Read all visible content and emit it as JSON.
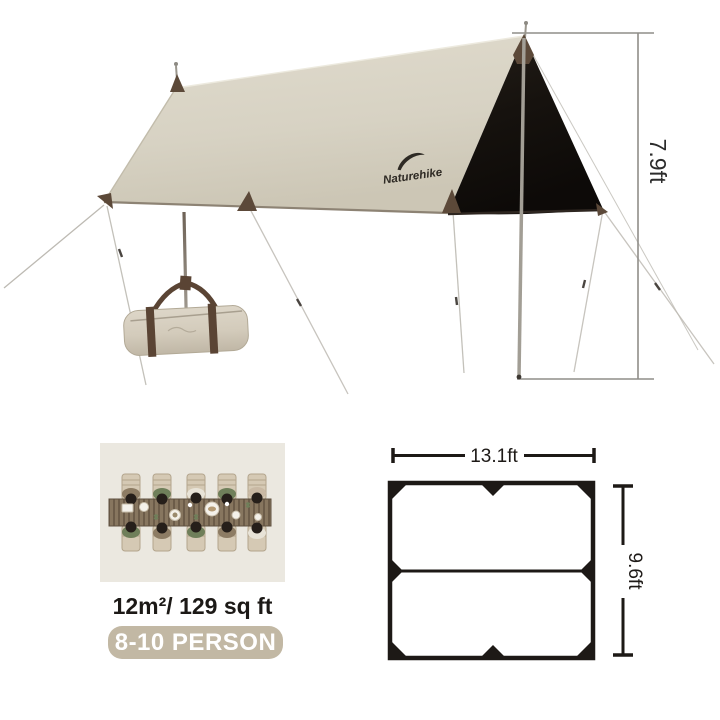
{
  "scene": {
    "brand": "Naturehike",
    "height_dimension": "7.9ft"
  },
  "capacity": {
    "area": "12m²/ 129 sq ft",
    "persons": "8-10 PERSON"
  },
  "floorplan": {
    "width": "13.1ft",
    "depth": "9.6ft"
  },
  "colors": {
    "tarp_beige": "#d8d3c5",
    "tarp_underside_black": "#17130f",
    "accent_brown": "#5c4939",
    "badge_tan": "#c2b8a4",
    "panel_bg": "#ebe8e0",
    "dimension_gray": "#8f8d89",
    "plan_black": "#1d1916",
    "badge_text": "#ffffff"
  }
}
